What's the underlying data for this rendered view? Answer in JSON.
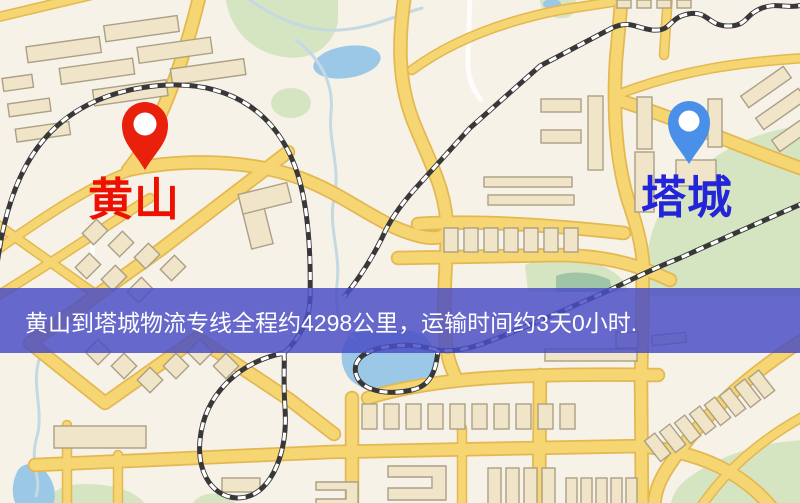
{
  "markers": {
    "origin": {
      "label": "黄山",
      "pin": "red-map-pin"
    },
    "destination": {
      "label": "塔城",
      "pin": "blue-map-pin"
    }
  },
  "banner": {
    "text": "黄山到塔城物流专线全程约4298公里，运输时间约3天0小时.",
    "distance_km": "4298",
    "transit_days": "3",
    "transit_hours": "0"
  },
  "colors": {
    "map-bg": "#f7f2e8",
    "origin-label": "#ee1000",
    "origin-pin": "#e8200c",
    "dest-label": "#2326d8",
    "dest-pin": "#4a8fe8",
    "banner-bg": "rgba(74,78,197,0.84)",
    "banner-text": "#ffffff",
    "road-fill": "#f6d573",
    "road-casing": "#e3b851",
    "building-fill": "#f0e5c8",
    "building-stroke": "#ab9f85",
    "green": "#d6e5c1",
    "green-dark": "#9fc4a8",
    "water": "#9cc8e8",
    "river": "#c5d9e2",
    "rail": "#383838"
  }
}
